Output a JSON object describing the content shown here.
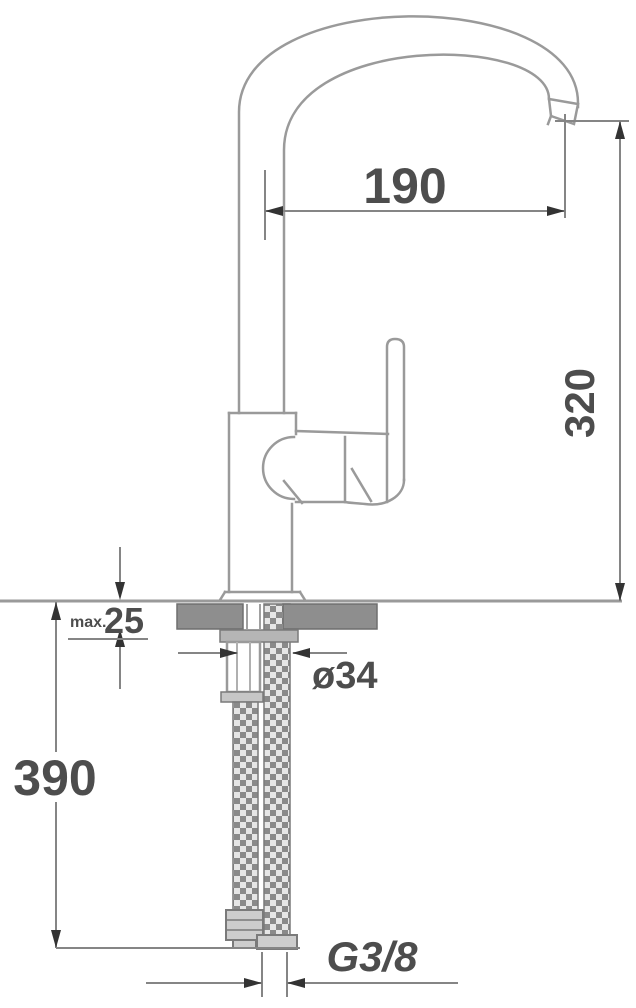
{
  "drawing": {
    "subject": "Single-lever kitchen mixer tap - side view installation dimension drawing",
    "labels": {
      "spout_reach": "190",
      "spout_height": "320",
      "deck_thickness_prefix": "max.",
      "deck_thickness": "25",
      "hole_diameter": "ø34",
      "hose_length": "390",
      "connection_thread": "G3/8"
    },
    "colors": {
      "outline": "#9a9a9a",
      "dimension_line": "#858585",
      "arrow": "#333333",
      "text": "#4d4d4d",
      "counter_section_fill": "#8e8e8e",
      "background": "#ffffff"
    }
  }
}
